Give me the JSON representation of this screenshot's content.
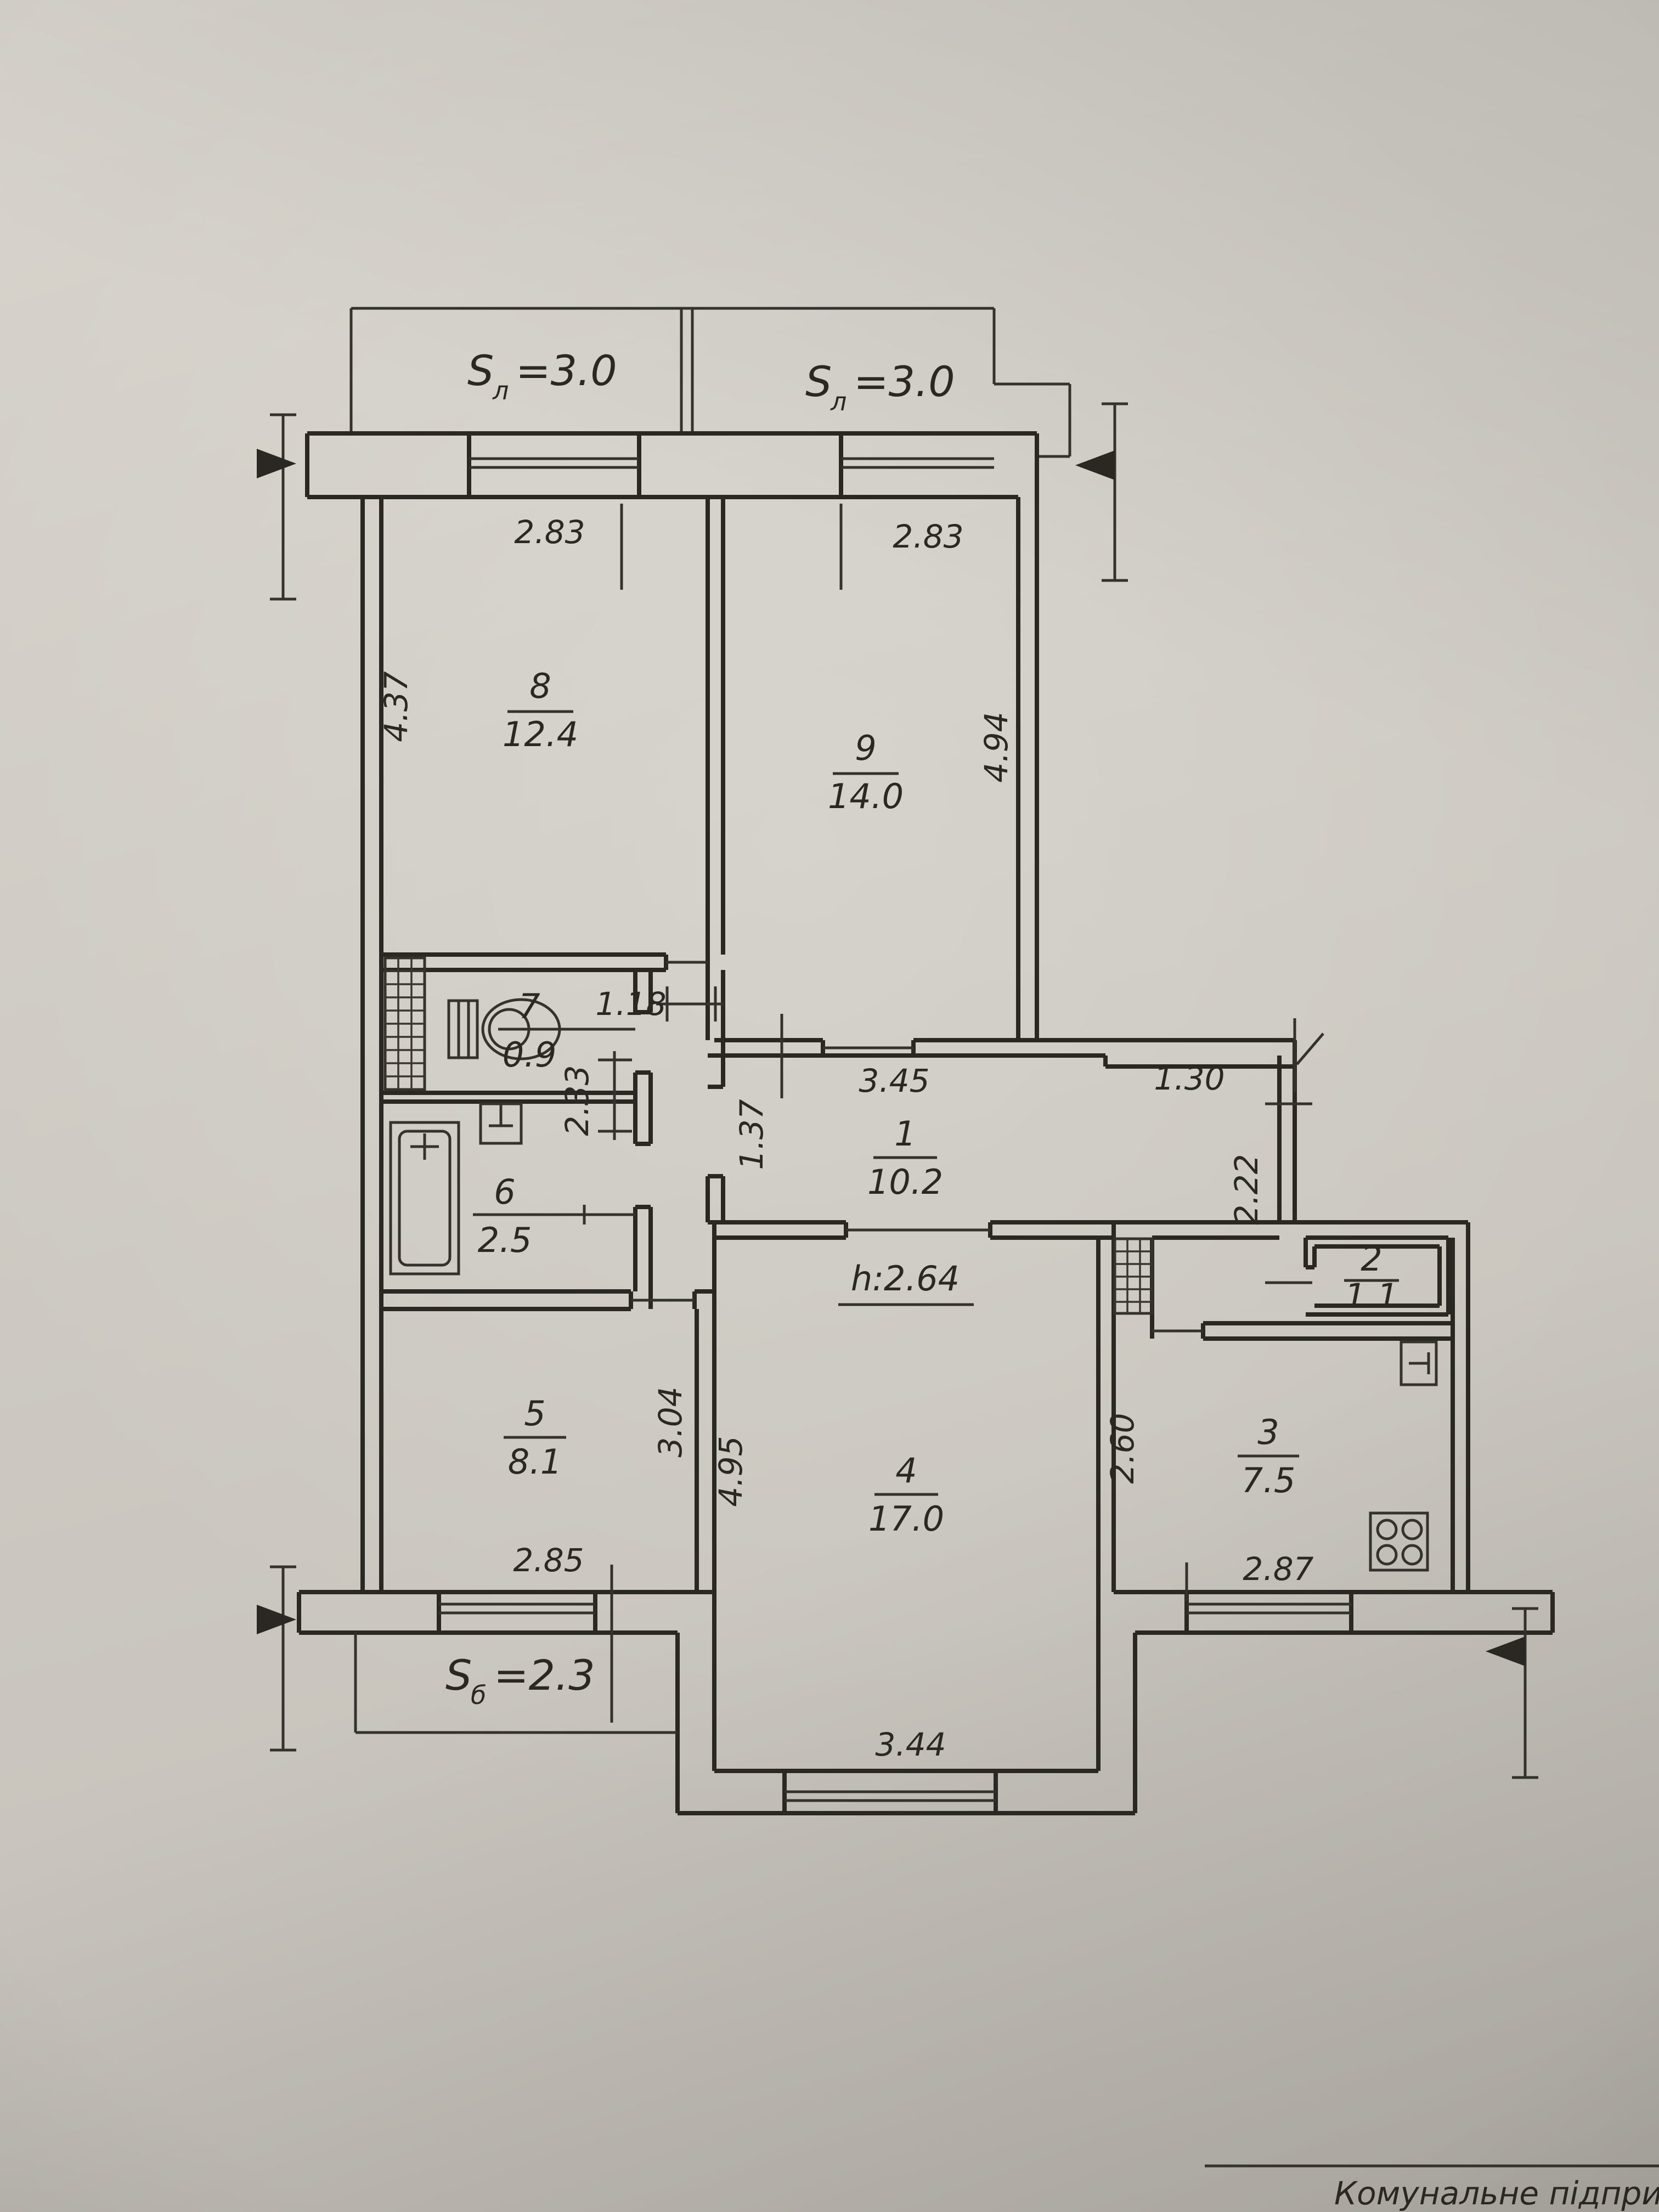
{
  "colors": {
    "paper": "#d0ccc5",
    "ink": "#2b2723"
  },
  "labels": {
    "loggia_left": {
      "symbol": "S",
      "subscript": "л",
      "value": "=3.0"
    },
    "loggia_right": {
      "symbol": "S",
      "subscript": "л",
      "value": "=3.0"
    },
    "balcony": {
      "symbol": "S",
      "subscript": "б",
      "value": "=2.3"
    },
    "ceiling_height": "h:2.64",
    "title_block_text": "Комунальне підприємст"
  },
  "rooms": [
    {
      "number": "1",
      "area": "10.2"
    },
    {
      "number": "2",
      "area": "1.1"
    },
    {
      "number": "3",
      "area": "7.5"
    },
    {
      "number": "4",
      "area": "17.0"
    },
    {
      "number": "5",
      "area": "8.1"
    },
    {
      "number": "6",
      "area": "2.5"
    },
    {
      "number": "7",
      "area": "0.9"
    },
    {
      "number": "8",
      "area": "12.4"
    },
    {
      "number": "9",
      "area": "14.0"
    }
  ],
  "dimensions": {
    "loggia_left_width": "2.83",
    "loggia_right_width": "2.83",
    "room8_depth": "4.37",
    "room9_depth": "4.94",
    "corridor_width": "1.18",
    "bath_depth": "2.33",
    "hall_width": "3.45",
    "hall_right_width": "1.30",
    "hall_passage": "1.37",
    "hall_right_depth": "2.22",
    "room5_depth": "3.04",
    "room5_window": "2.85",
    "room4_depth": "4.95",
    "room4_window": "3.44",
    "kitchen_depth": "2.60",
    "kitchen_window": "2.87"
  },
  "fixtures": [
    "toilet-icon",
    "washbasin-icon",
    "bathtub-icon",
    "sink-icon",
    "stove-icon",
    "vent-shaft-icon",
    "vent-shaft-icon"
  ]
}
